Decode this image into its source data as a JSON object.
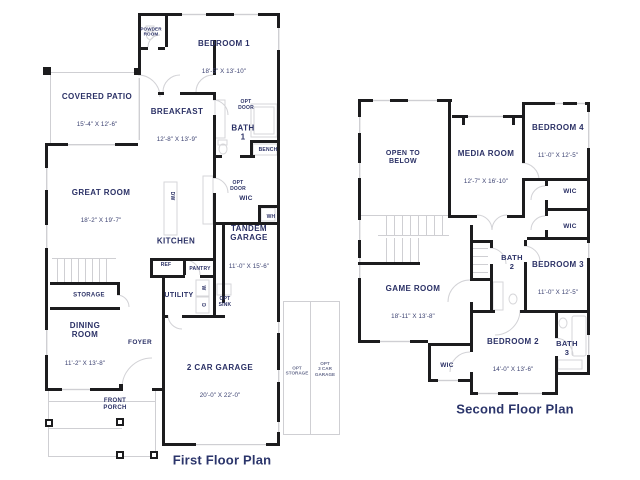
{
  "colors": {
    "wall": "#1c1c1e",
    "room_text": "#2b3166",
    "light_line": "#cfcfd3",
    "title_text": "#2b356b",
    "background": "#ffffff"
  },
  "ff": {
    "title": "First Floor Plan",
    "powder": "POWDER\nROOM",
    "bedroom1": {
      "n": "BEDROOM 1",
      "d": "18'-5\" X 13'-10\""
    },
    "patio": {
      "n": "COVERED PATIO",
      "d": "15'-4\" X 12'-6\""
    },
    "breakfast": {
      "n": "BREAKFAST",
      "d": "12'-8\" X 13'-9\""
    },
    "bath1": "BATH\n1",
    "optdoor": "OPT\nDOOR",
    "bench": "BENCH",
    "wic": "WIC",
    "wh": "WH",
    "greatroom": {
      "n": "GREAT ROOM",
      "d": "18'-2\" X 19'-7\""
    },
    "kitchen": "KITCHEN",
    "dw": "DW",
    "tandem": {
      "n": "TANDEM\nGARAGE",
      "d": "11'-0\" X 15'-6\""
    },
    "ref": "REF",
    "pantry": "PANTRY",
    "utility": "UTILITY",
    "w": "W",
    "d": "D",
    "optsink": "OPT\nSINK",
    "storage": "STORAGE",
    "dining": {
      "n": "DINING\nROOM",
      "d": "11'-2\" X 13'-8\""
    },
    "foyer": "FOYER",
    "garage": {
      "n": "2 CAR GARAGE",
      "d": "20'-0\" X 22'-0\""
    },
    "porch": "FRONT\nPORCH",
    "optstorage": "OPT\nSTORAGE",
    "opt3car": "OPT\n3 CAR\nGARAGE"
  },
  "sf": {
    "title": "Second Floor Plan",
    "open": "OPEN TO\nBELOW",
    "media": {
      "n": "MEDIA ROOM",
      "d": "12'-7\" X 16'-10\""
    },
    "bedroom4": {
      "n": "BEDROOM 4",
      "d": "11'-0\" X 12'-5\""
    },
    "game": {
      "n": "GAME ROOM",
      "d": "18'-11\" X 13'-8\""
    },
    "bath2": "BATH\n2",
    "bedroom3": {
      "n": "BEDROOM 3",
      "d": "11'-0\" X 12'-5\""
    },
    "bedroom2": {
      "n": "BEDROOM 2",
      "d": "14'-0\" X 13'-6\""
    },
    "bath3": "BATH\n3"
  }
}
